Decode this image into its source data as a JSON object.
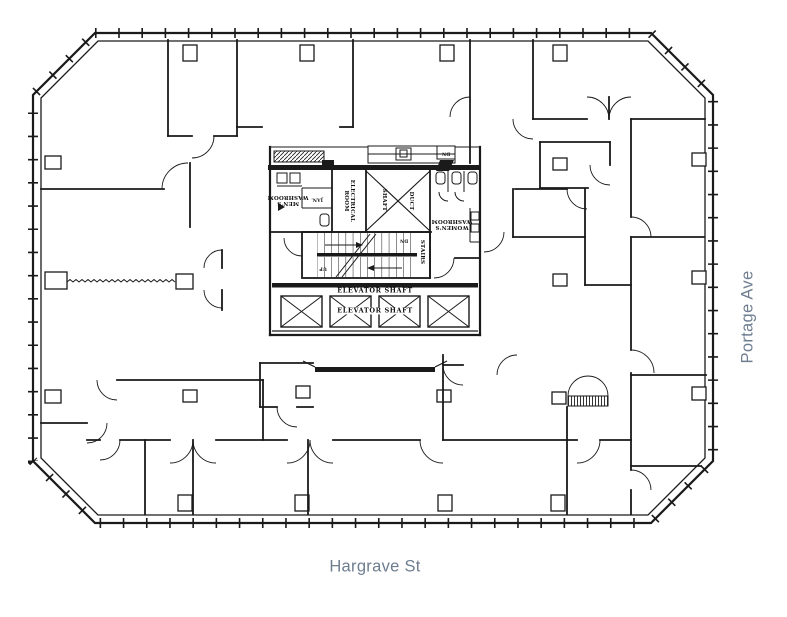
{
  "canvas": {
    "width": 787,
    "height": 617,
    "background": "#ffffff",
    "line_color": "#1a1a1a"
  },
  "streets": {
    "bottom_label": "Hargrave St",
    "right_label": "Portage Ave",
    "label_color": "#6e7d90"
  },
  "core_labels": {
    "mens_washroom_line1": "MEN'S",
    "mens_washroom_line2": "WASHROOM",
    "janitor": "JAN.",
    "electrical_line1": "ELECTRICAL",
    "electrical_line2": "ROOM",
    "shaft": "SHAFT",
    "duct": "DUCT",
    "womens_washroom_line1": "WOMEN'S",
    "womens_washroom_line2": "WASHROOM",
    "stairs": "STAIRS",
    "stairs_dn": "DN",
    "stairs_up": "UP",
    "strip_dn": "DN",
    "elevator_header": "ELEVATOR SHAFT",
    "elevator_inner": "ELEVATOR SHAFT"
  }
}
